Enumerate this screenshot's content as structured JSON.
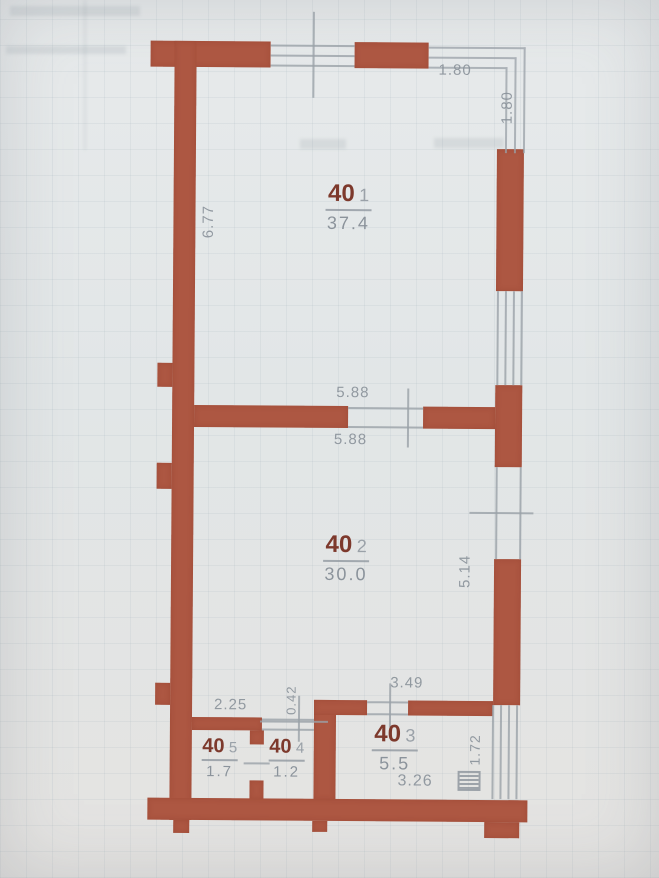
{
  "title": "apartment-floor-plan-scan",
  "colors": {
    "wall": "#ad5742",
    "room_number": "#7d392c",
    "dim_text": "#8b939b",
    "thin_line": "#9aa1a8",
    "background": "#e3e6e7"
  },
  "rooms": [
    {
      "id": "40-1",
      "number": "40",
      "index": "1",
      "area": "37.4"
    },
    {
      "id": "40-2",
      "number": "40",
      "index": "2",
      "area": "30.0"
    },
    {
      "id": "40-3",
      "number": "40",
      "index": "3",
      "area": "5.5"
    },
    {
      "id": "40-4",
      "number": "40",
      "index": "4",
      "area": "1.2"
    },
    {
      "id": "40-5",
      "number": "40",
      "index": "5",
      "area": "1.7"
    }
  ],
  "dims": {
    "balcony_width": "1.80",
    "balcony_depth": "1.80",
    "room1_height": "6.77",
    "opening_top": "5.88",
    "opening_bottom": "5.88",
    "room2_height": "5.14",
    "hall_width": "2.25",
    "door_width": "0.42",
    "room3_opening": "3.49",
    "loggia_window": "1.72",
    "room3_width": "3.26"
  },
  "icons": {
    "vent_shaft": "vent-shaft-icon"
  }
}
